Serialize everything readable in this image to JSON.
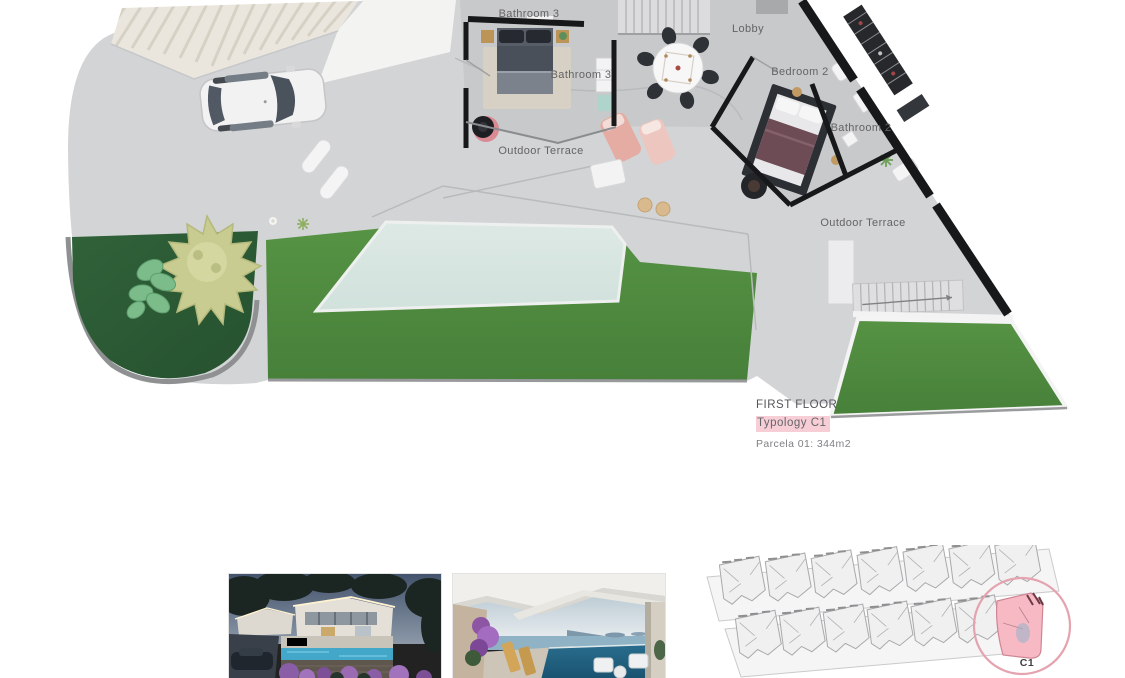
{
  "floor_plan": {
    "room_labels": {
      "bathroom3_upper": "Bathroom 3",
      "bathroom3_lower": "Bathroom 3",
      "lobby": "Lobby",
      "bedroom2": "Bedroom 2",
      "bathroom2": "Bathroom 2",
      "outdoor_terrace_west": "Outdoor Terrace",
      "outdoor_terrace_east": "Outdoor Terrace"
    },
    "colors": {
      "hardscape": "#d3d4d6",
      "interior_floor": "#c8c9cb",
      "lawn": "#4e8c3c",
      "planting_bed": "#2e5f3a",
      "pool": "#d9e7e2",
      "wall": "#17181a",
      "pergola": "#eae6de"
    }
  },
  "caption": {
    "floor": "FIRST FLOOR",
    "typology": "Typology C1",
    "parcel": "Parcela 01: 344m2",
    "highlight_color": "#f7ced6"
  },
  "site_plan": {
    "highlighted_unit": "C1",
    "highlight_fill": "#f7bac5",
    "ring_color": "#e5a3af"
  },
  "photos": [
    {
      "name": "exterior-night-render"
    },
    {
      "name": "terrace-sea-view-render"
    }
  ]
}
